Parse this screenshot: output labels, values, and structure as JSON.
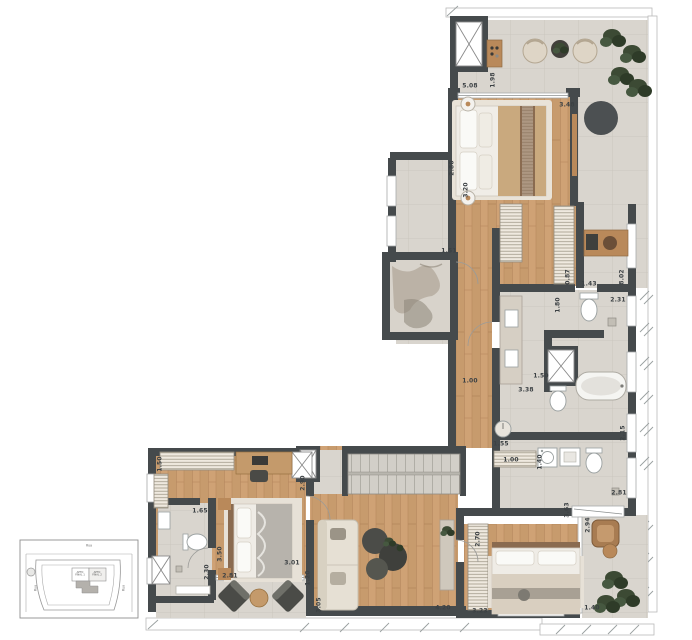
{
  "colors": {
    "wall": "#454a4c",
    "wood_floor": "#c79b6d",
    "concrete_floor": "#d9d5ce",
    "rug": "#e9e3d8",
    "plant": "#3c4a34",
    "fixture_stroke": "#9aa0a0",
    "wood_furniture": "#b9895a"
  },
  "dimensions": [
    {
      "text": "5.08",
      "x": 470,
      "y": 86,
      "v": false
    },
    {
      "text": "1.98",
      "x": 493,
      "y": 80,
      "v": true
    },
    {
      "text": "3.48",
      "x": 567,
      "y": 105,
      "v": false
    },
    {
      "text": "2.80",
      "x": 452,
      "y": 168,
      "v": true
    },
    {
      "text": "3.20",
      "x": 466,
      "y": 190,
      "v": true
    },
    {
      "text": "1.51",
      "x": 449,
      "y": 251,
      "v": false
    },
    {
      "text": "0.87",
      "x": 568,
      "y": 277,
      "v": true
    },
    {
      "text": "1.43",
      "x": 589,
      "y": 284,
      "v": false
    },
    {
      "text": "8.02",
      "x": 622,
      "y": 277,
      "v": true
    },
    {
      "text": "1.80",
      "x": 558,
      "y": 305,
      "v": true
    },
    {
      "text": "2.31",
      "x": 618,
      "y": 300,
      "v": false
    },
    {
      "text": "1.00",
      "x": 470,
      "y": 381,
      "v": false
    },
    {
      "text": "3.38",
      "x": 526,
      "y": 390,
      "v": false
    },
    {
      "text": "1.50",
      "x": 541,
      "y": 376,
      "v": false
    },
    {
      "text": "2.15",
      "x": 623,
      "y": 433,
      "v": true
    },
    {
      "text": "1.55",
      "x": 501,
      "y": 444,
      "v": false
    },
    {
      "text": "1.00",
      "x": 511,
      "y": 460,
      "v": false
    },
    {
      "text": "1.40",
      "x": 540,
      "y": 462,
      "v": true
    },
    {
      "text": "2.81",
      "x": 619,
      "y": 493,
      "v": false
    },
    {
      "text": "3.63",
      "x": 567,
      "y": 510,
      "v": true
    },
    {
      "text": "2.94",
      "x": 588,
      "y": 525,
      "v": true
    },
    {
      "text": "2.70",
      "x": 478,
      "y": 539,
      "v": true
    },
    {
      "text": "3.23",
      "x": 480,
      "y": 611,
      "v": false
    },
    {
      "text": "1.40",
      "x": 592,
      "y": 608,
      "v": false
    },
    {
      "text": "4.20",
      "x": 443,
      "y": 608,
      "v": false
    },
    {
      "text": "3.05",
      "x": 319,
      "y": 605,
      "v": true
    },
    {
      "text": "1.20",
      "x": 308,
      "y": 578,
      "v": true
    },
    {
      "text": "2.90",
      "x": 303,
      "y": 483,
      "v": true
    },
    {
      "text": "1.50",
      "x": 160,
      "y": 464,
      "v": true
    },
    {
      "text": "1.65",
      "x": 200,
      "y": 511,
      "v": false
    },
    {
      "text": "3.50",
      "x": 220,
      "y": 554,
      "v": true
    },
    {
      "text": "2.30",
      "x": 207,
      "y": 572,
      "v": true
    },
    {
      "text": "2.81",
      "x": 230,
      "y": 576,
      "v": false
    },
    {
      "text": "3.01",
      "x": 292,
      "y": 563,
      "v": false
    }
  ],
  "key_plan": {
    "street_top": "Rua",
    "street_left": "Rua",
    "street_right": "Rua",
    "unit_1_line1": "APTO",
    "unit_1_line2": "FINAL 1",
    "unit_2_line1": "APTO",
    "unit_2_line2": "FINAL 2"
  }
}
